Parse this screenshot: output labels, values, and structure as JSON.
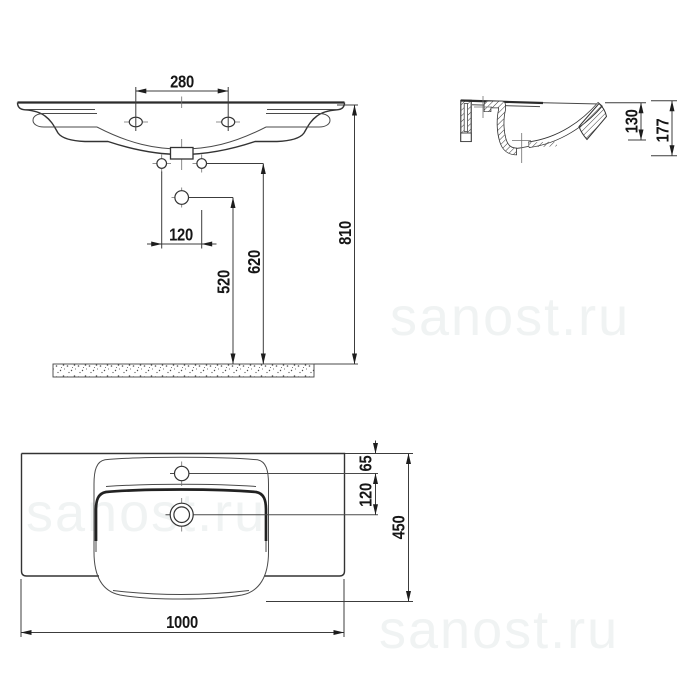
{
  "title": "washbasin-technical-drawing",
  "watermark": {
    "text": "sanost.ru",
    "color": "#f0f3f3"
  },
  "views": {
    "front": "front-view",
    "side": "side-section-view",
    "plan": "plan-view"
  },
  "dimensions": {
    "front": {
      "tap_hole_spacing": "280",
      "fixing_hole_spacing": "120",
      "siphon_height": "520",
      "fixing_height": "620",
      "rim_height": "810"
    },
    "side": {
      "bowl_depth": "130",
      "total_depth": "177"
    },
    "plan": {
      "tap_hole_offset": "65",
      "drain_offset": "120",
      "basin_depth": "450",
      "basin_width": "1000"
    }
  },
  "line_color": "#333333",
  "background_color": "#ffffff"
}
